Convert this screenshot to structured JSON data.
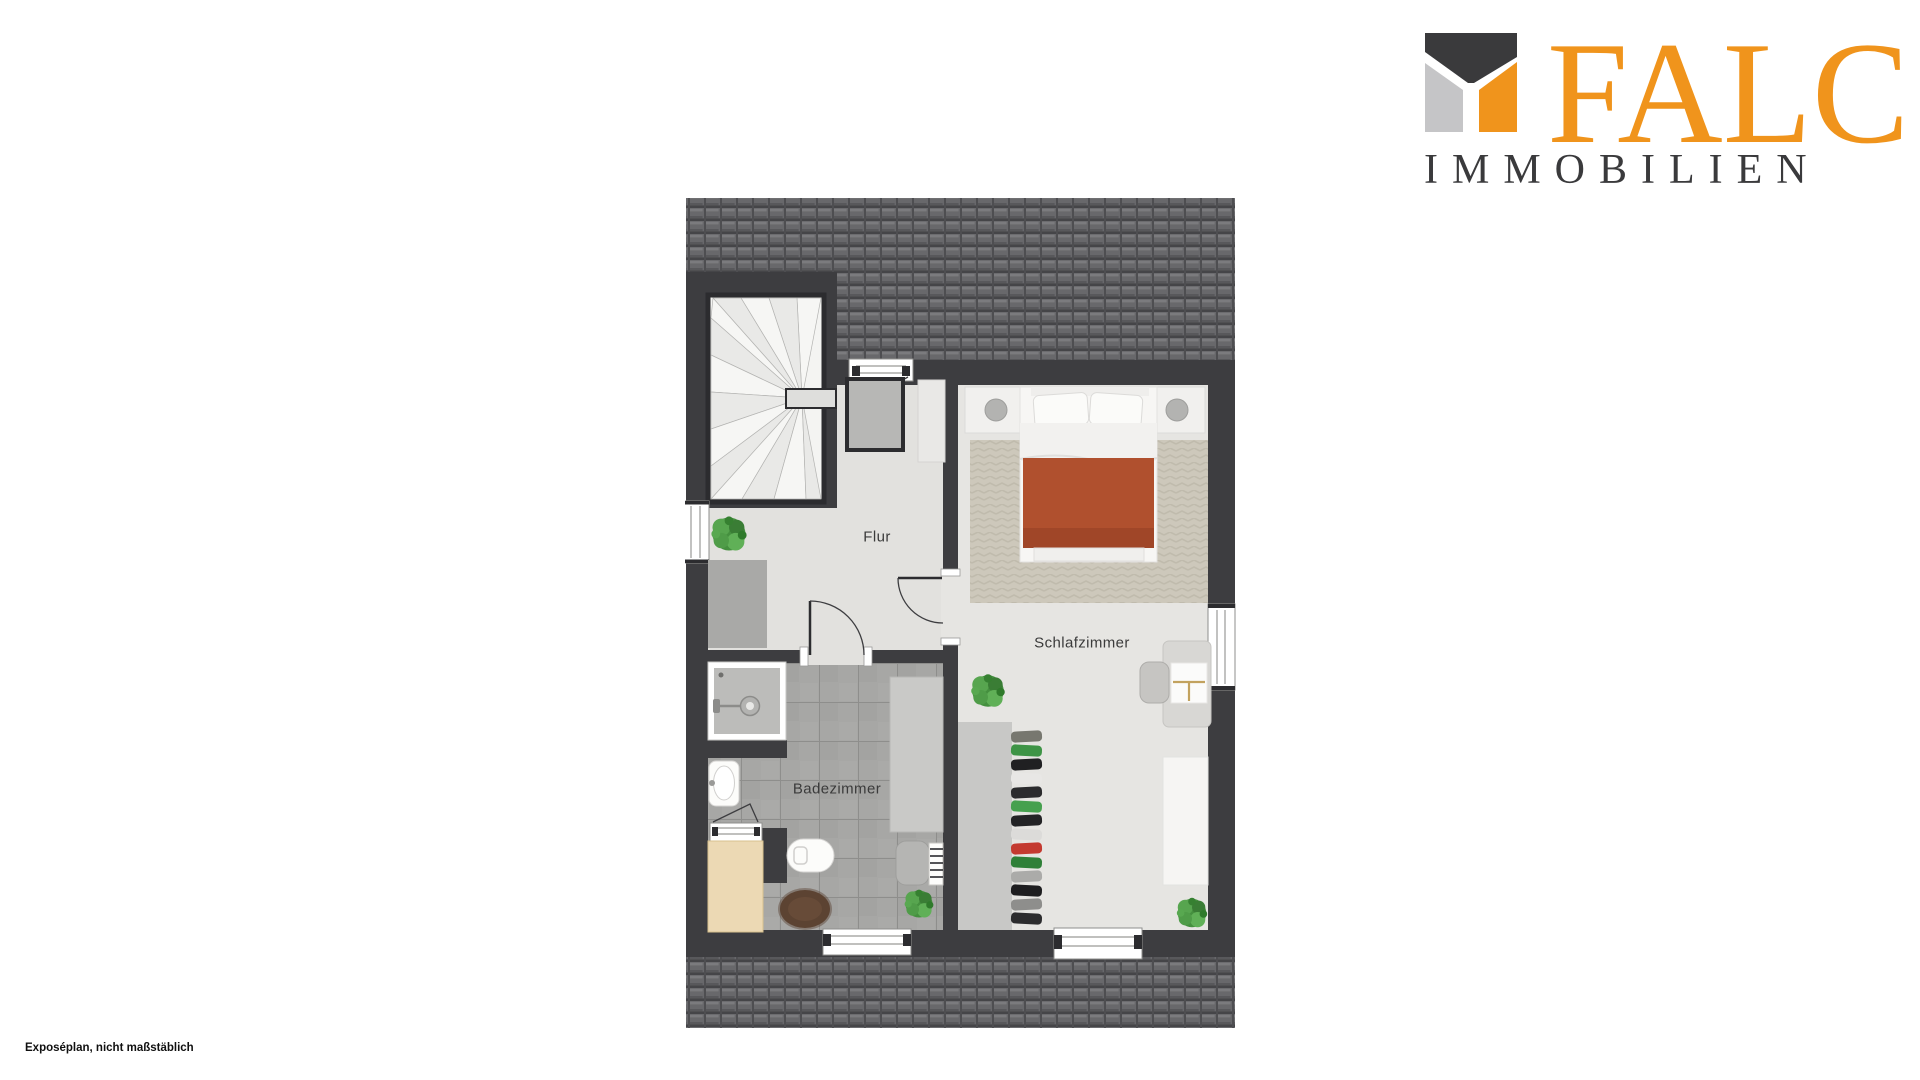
{
  "branding": {
    "company": "FALC",
    "tagline": "IMMOBILIEN",
    "colors": {
      "orange": "#F0941C",
      "dark_gray": "#3A3A3C",
      "light_gray": "#C5C5C7"
    }
  },
  "footer": {
    "note": "Exposéplan, nicht maßstäblich"
  },
  "floorplan": {
    "rooms": [
      {
        "id": "flur",
        "label": "Flur"
      },
      {
        "id": "schlafzimmer",
        "label": "Schlafzimmer"
      },
      {
        "id": "badezimmer",
        "label": "Badezimmer"
      }
    ],
    "colors": {
      "wall": "#3D3D40",
      "roof_tiles": "#68686B",
      "floor": "#E3E2DF",
      "stair_floor": "#F4F4F2",
      "bath_tile": "#A7A7A5",
      "carpet": "#CDC8BB",
      "bed_blanket": "#B0502E",
      "wood_chest": "#ECD9B4",
      "plant_green": "#4C9A44",
      "rug_brown": "#5C4332"
    },
    "furniture": [
      "winder-staircase",
      "skylight-window-box",
      "sideboard",
      "tall-cabinet",
      "double-bed",
      "nightstand-left",
      "nightstand-right",
      "area-rug",
      "open-wardrobe-with-clothes",
      "desk",
      "desk-chair",
      "bench",
      "shower",
      "washbasin",
      "toilet",
      "wooden-chest",
      "bath-rug",
      "bathroom-cabinet",
      "stool",
      "towel-radiator",
      "plants"
    ]
  }
}
